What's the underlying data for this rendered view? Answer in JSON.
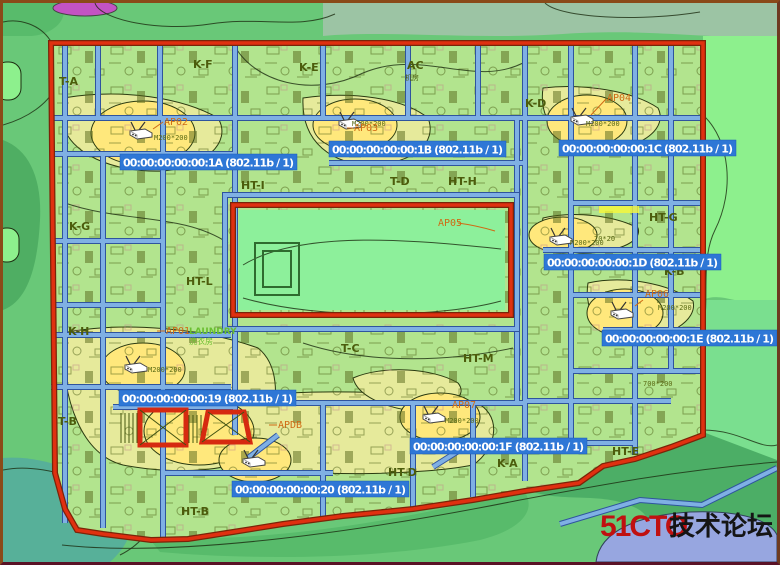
{
  "document_type": "wifi-coverage-floor-plan",
  "watermark": {
    "brand": "51CTO",
    "forum_text": "技术论坛",
    "brand_color": "#c01010"
  },
  "mac_labels": [
    "00:00:00:00:00:1A (802.11b / 1)",
    "00:00:00:00:00:1B (802.11b / 1)",
    "00:00:00:00:00:1C (802.11b / 1)",
    "00:00:00:00:00:1D (802.11b / 1)",
    "00:00:00:00:00:1E (802.11b / 1)",
    "00:00:00:00:00:19 (802.11b / 1)",
    "00:00:00:00:00:1F (802.11b / 1)",
    "00:00:00:00:00:20 (802.11b / 1)"
  ],
  "ap_tags": [
    "AP01",
    "AP02",
    "AP03",
    "AP04",
    "AP05",
    "AP06",
    "AP07",
    "APDB"
  ],
  "rooms": [
    "T-A",
    "K-F",
    "K-E",
    "AC",
    "机房",
    "K-D",
    "HT-I",
    "T-D",
    "HT-H",
    "K-C",
    "HT-G",
    "K-G",
    "HT-L",
    "K-H",
    "T-C",
    "HT-M",
    "K-B",
    "K-A",
    "HT-E",
    "HT-D",
    "HT-B",
    "T-B"
  ],
  "notes": {
    "laundry": "LAUNDRY",
    "laundry_cn": "洗衣房"
  },
  "dim_texts": [
    "M200*200",
    "M200*200",
    "M200*200",
    "M200*200",
    "M200*200",
    "M200*200",
    "M200*200",
    "700*200",
    "70*20"
  ],
  "icons": {
    "ap": "wifi-access-point-router-icon"
  },
  "colors": {
    "mac_label_bg": "#2e77d6",
    "mac_label_text": "#ffffff",
    "ap_tag": "#cf6a14",
    "room_label": "#4c5c0c",
    "building_outline": "#e03010",
    "wall": "#7fb0e4",
    "heat_strong": "#ffe87c",
    "heat_mid": "#e6ea9b",
    "heat_light": "#b2e48e",
    "outside_green": "#69c878",
    "watermark_red": "#c01010"
  }
}
